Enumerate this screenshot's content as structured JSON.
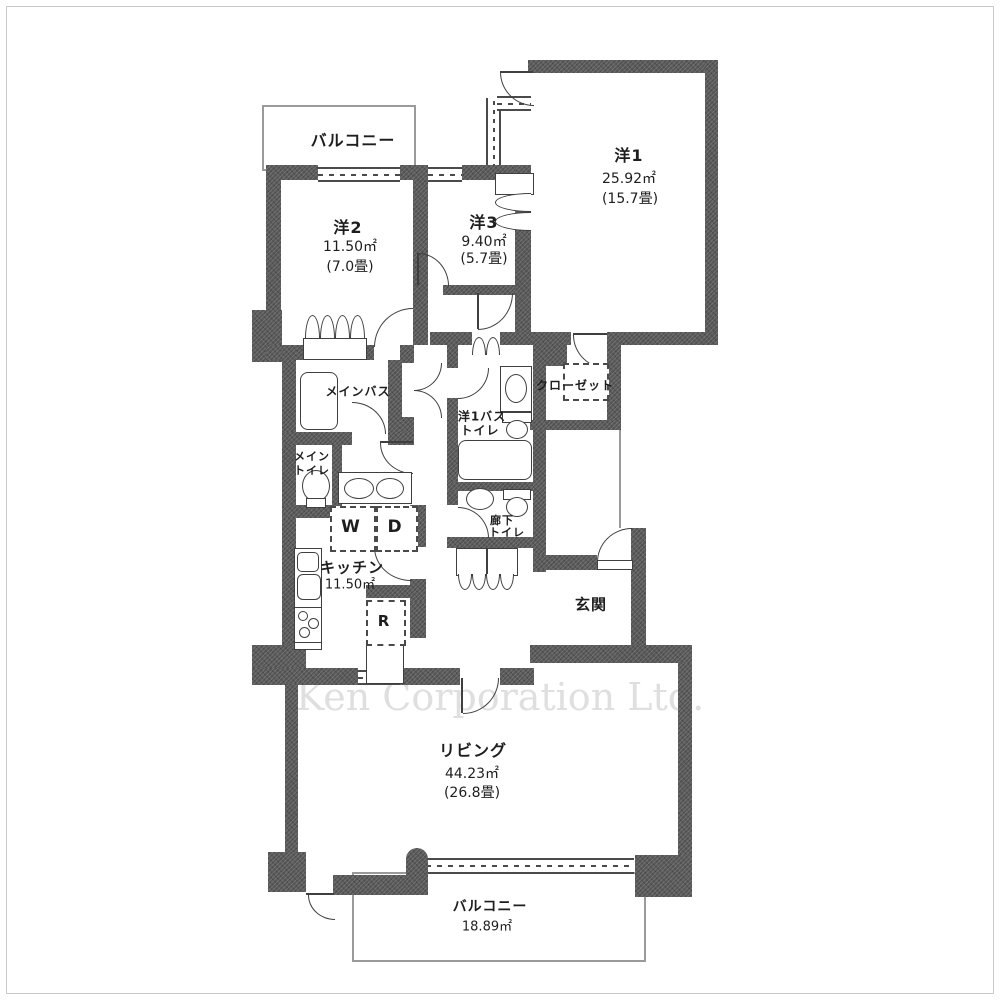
{
  "company_watermark": "Ken Corporation Ltd.",
  "rooms": {
    "balcony_top": {
      "name": "バルコニー"
    },
    "western2": {
      "name": "洋2",
      "area_sqm": "11.50㎡",
      "area_tatami": "(7.0畳)"
    },
    "western3": {
      "name": "洋3",
      "area_sqm": "9.40㎡",
      "area_tatami": "(5.7畳)"
    },
    "western1": {
      "name": "洋1",
      "area_sqm": "25.92㎡",
      "area_tatami": "(15.7畳)"
    },
    "closet": {
      "name": "クローゼット"
    },
    "main_bath": {
      "name": "メインバス"
    },
    "main_toilet": {
      "name_line1": "メイン",
      "name_line2": "トイレ"
    },
    "western1_bath_toilet": {
      "name_line1": "洋1バス",
      "name_line2": "トイレ"
    },
    "laundry": {
      "washer": "W",
      "dryer": "D"
    },
    "kitchen": {
      "name": "キッチン",
      "area_sqm": "11.50㎡",
      "refrigerator": "R"
    },
    "hall_toilet": {
      "name_line1": "廊下",
      "name_line2": "トイレ"
    },
    "entrance": {
      "name": "玄関"
    },
    "living": {
      "name": "リビング",
      "area_sqm": "44.23㎡",
      "area_tatami": "(26.8畳)"
    },
    "balcony_bottom": {
      "name": "バルコニー",
      "area_sqm": "18.89㎡"
    }
  },
  "colors": {
    "wall": "#5a5a5a",
    "line": "#3f3f3f",
    "outline": "#9a9a9a",
    "watermark": "#dfdfdf"
  }
}
